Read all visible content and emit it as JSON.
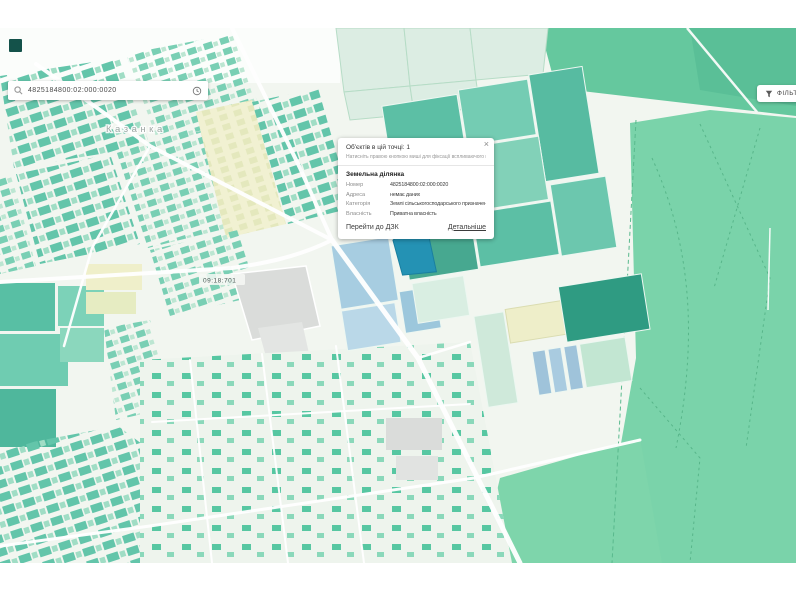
{
  "search": {
    "value": "4825184800:02:000:0020",
    "icons": {
      "left": "search-icon",
      "right": "history-icon"
    }
  },
  "filter_button": {
    "label": "ФІЛЬТРИ"
  },
  "popup": {
    "title": "Об'єктів в цій точці: 1",
    "hint": "Натисніть правою кнопкою миші для фіксації вспливаючого вікна.",
    "section_title": "Земельна ділянка",
    "fields": [
      {
        "label": "Номер",
        "value": "4825184800:02:000:0020"
      },
      {
        "label": "Адреса",
        "value": "немає даних"
      },
      {
        "label": "Категорія",
        "value": "Землі сільськогосподарського призначення"
      },
      {
        "label": "Власність",
        "value": "Приватна власність"
      }
    ],
    "links": {
      "dzk": "Перейти до ДЗК",
      "details": "Детальніше"
    },
    "close_label": "×"
  },
  "map": {
    "place_label": "Казанка",
    "zone_label": "09:18:701",
    "colors": {
      "background": "#f2f6f0",
      "parcel_teal": "#5cbfa5",
      "parcel_light": "#a0ddc5",
      "parcel_blue": "#a7cde1",
      "selected_parcel": "#2492b4",
      "field_yellow": "#efefca",
      "forest_green": "#7ad3aa",
      "industrial_gray": "#dadcda",
      "road": "#ffffff"
    }
  }
}
